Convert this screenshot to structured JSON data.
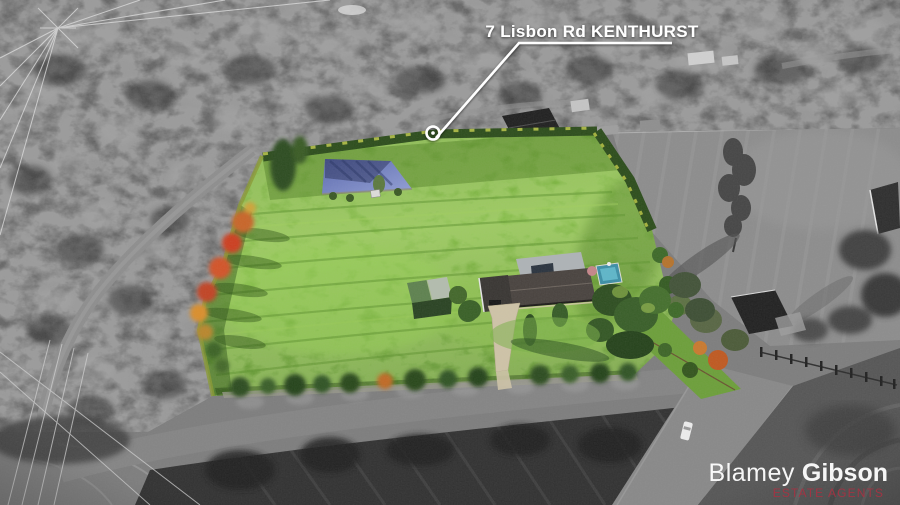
{
  "annotation": {
    "address_label": "7 Lisbon Rd KENTHURST",
    "marker_icon": "circle-ring-marker",
    "leader_line_color": "#ffffff"
  },
  "branding": {
    "agency_first": "Blamey",
    "agency_last": "Gibson",
    "tagline": "ESTATE AGENTS"
  },
  "colors": {
    "label_text": "#ffffff",
    "logo_text": "#ffffff",
    "tagline": "#a53343",
    "field_green": "#7cb23e",
    "pond_blue": "#7585c4",
    "pool_teal": "#4aa7bd",
    "autumn_orange": "#c8662a",
    "hedge_green": "#2e4e1d"
  },
  "scene": {
    "subject": "aerial photo of rural property shown in colour against desaturated surroundings",
    "features": [
      "dam",
      "grass paddock",
      "main house",
      "farm shed",
      "swimming pool",
      "driveway",
      "autumn trees",
      "boundary hedges",
      "power lines",
      "roads",
      "neighbouring paddock",
      "earthworks"
    ]
  }
}
